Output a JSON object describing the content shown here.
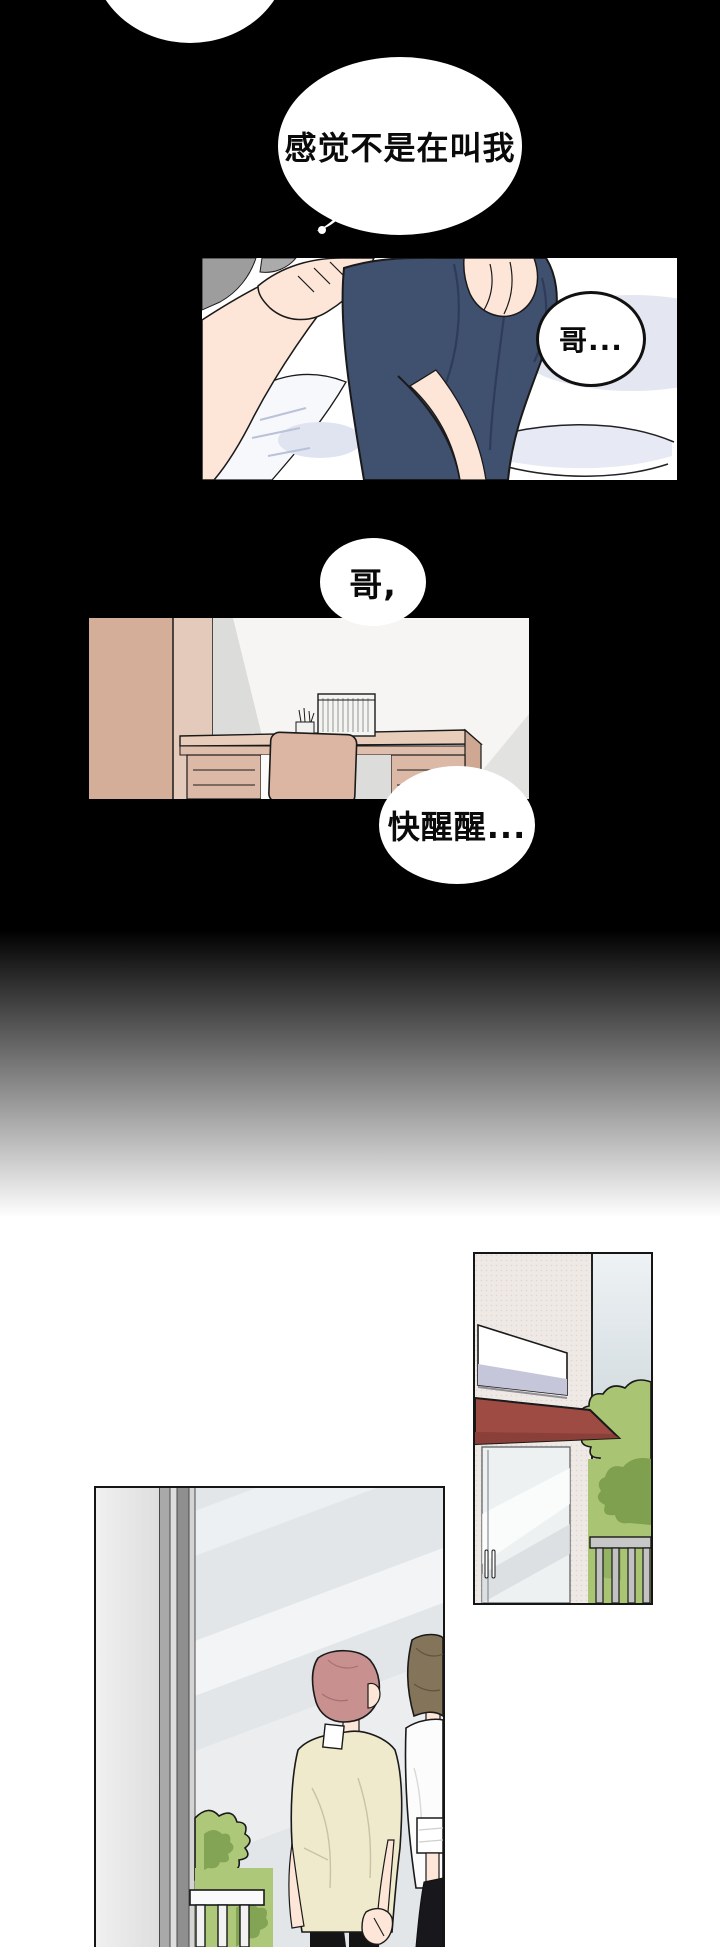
{
  "page": {
    "type": "webtoon-comic-page",
    "background_color": "#000000",
    "width": 720,
    "height": 1947
  },
  "bubbles": {
    "thought_main": {
      "text": "感觉不是在叫我"
    },
    "ge_ellipsis": {
      "text": "哥..."
    },
    "ge_comma": {
      "text": "哥,"
    },
    "wake_up": {
      "text": "快醒醒..."
    }
  },
  "panels": {
    "bed_scene": {
      "description": "person in navy shirt on bed, hand on shoulder"
    },
    "room_scene": {
      "description": "room with wardrobe, desk, chair, radiator"
    },
    "building_scene": {
      "description": "storefront wall, sign, red awning, glass door, bushes, railing"
    },
    "street_scene": {
      "description": "two people from behind through glass: pink-haired in cream shirt, brown-haired in white shirt"
    }
  },
  "colors": {
    "navy_shirt": "#40506f",
    "skin": "#fde5d8",
    "gray_hair": "#9d9d9d",
    "bed_shadow": "#e4e7f1",
    "wardrobe_tan": "#d5ae9a",
    "desk_tan": "#e9cdbb",
    "chair_tan": "#dcb6a2",
    "awning_red": "#9d4b43",
    "awning_red_dark": "#8a3f39",
    "sign_lavender": "#c6c6da",
    "bush_green": "#a9c573",
    "bush_green_dark": "#7fa04f",
    "sky_blue_gray": "#c9d3d8",
    "pink_hair": "#c8908f",
    "brown_hair": "#84755a",
    "cream_shirt": "#efeacb",
    "black_pants": "#141414",
    "glass": "#e2e6e9"
  }
}
